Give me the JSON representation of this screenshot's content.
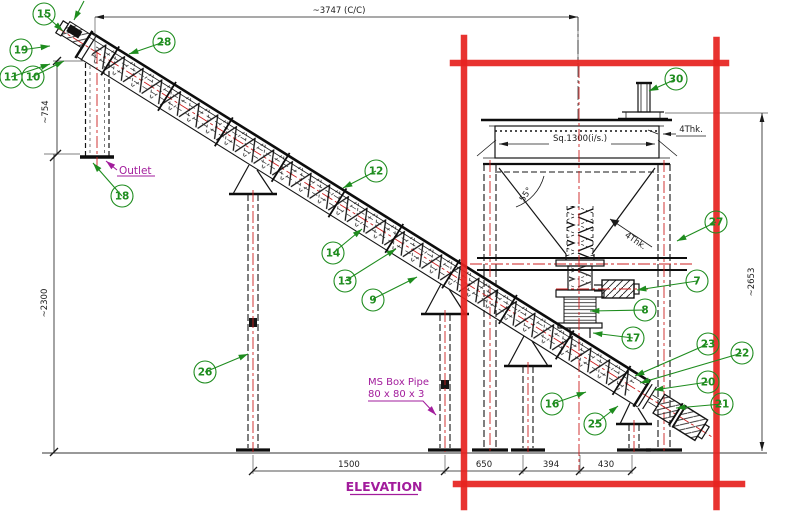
{
  "view": {
    "title": "ELEVATION"
  },
  "labels": {
    "outlet": "Outlet",
    "box_pipe_line1": "MS Box Pipe",
    "box_pipe_line2": "80 x 80 x 3"
  },
  "dimensions": {
    "total_cc": "~3747 (C/C)",
    "head_height": "~754",
    "leg_height": "~2300",
    "hopper_height": "~2653",
    "hopper_inside": "Sq.1300(i/s.)",
    "wall_thk_top": "4Thk.",
    "wall_thk_cone": "4Thk.",
    "cone_angle": "55°",
    "span_a": "1500",
    "span_b": "650",
    "span_c": "394",
    "span_d": "430"
  },
  "balloons": [
    {
      "n": "15"
    },
    {
      "n": "19"
    },
    {
      "n": "11"
    },
    {
      "n": "10"
    },
    {
      "n": "28"
    },
    {
      "n": "18"
    },
    {
      "n": "12"
    },
    {
      "n": "14"
    },
    {
      "n": "13"
    },
    {
      "n": "9"
    },
    {
      "n": "26"
    },
    {
      "n": "30"
    },
    {
      "n": "27"
    },
    {
      "n": "7"
    },
    {
      "n": "8"
    },
    {
      "n": "17"
    },
    {
      "n": "23"
    },
    {
      "n": "22"
    },
    {
      "n": "20"
    },
    {
      "n": "21"
    },
    {
      "n": "16"
    },
    {
      "n": "25"
    }
  ]
}
